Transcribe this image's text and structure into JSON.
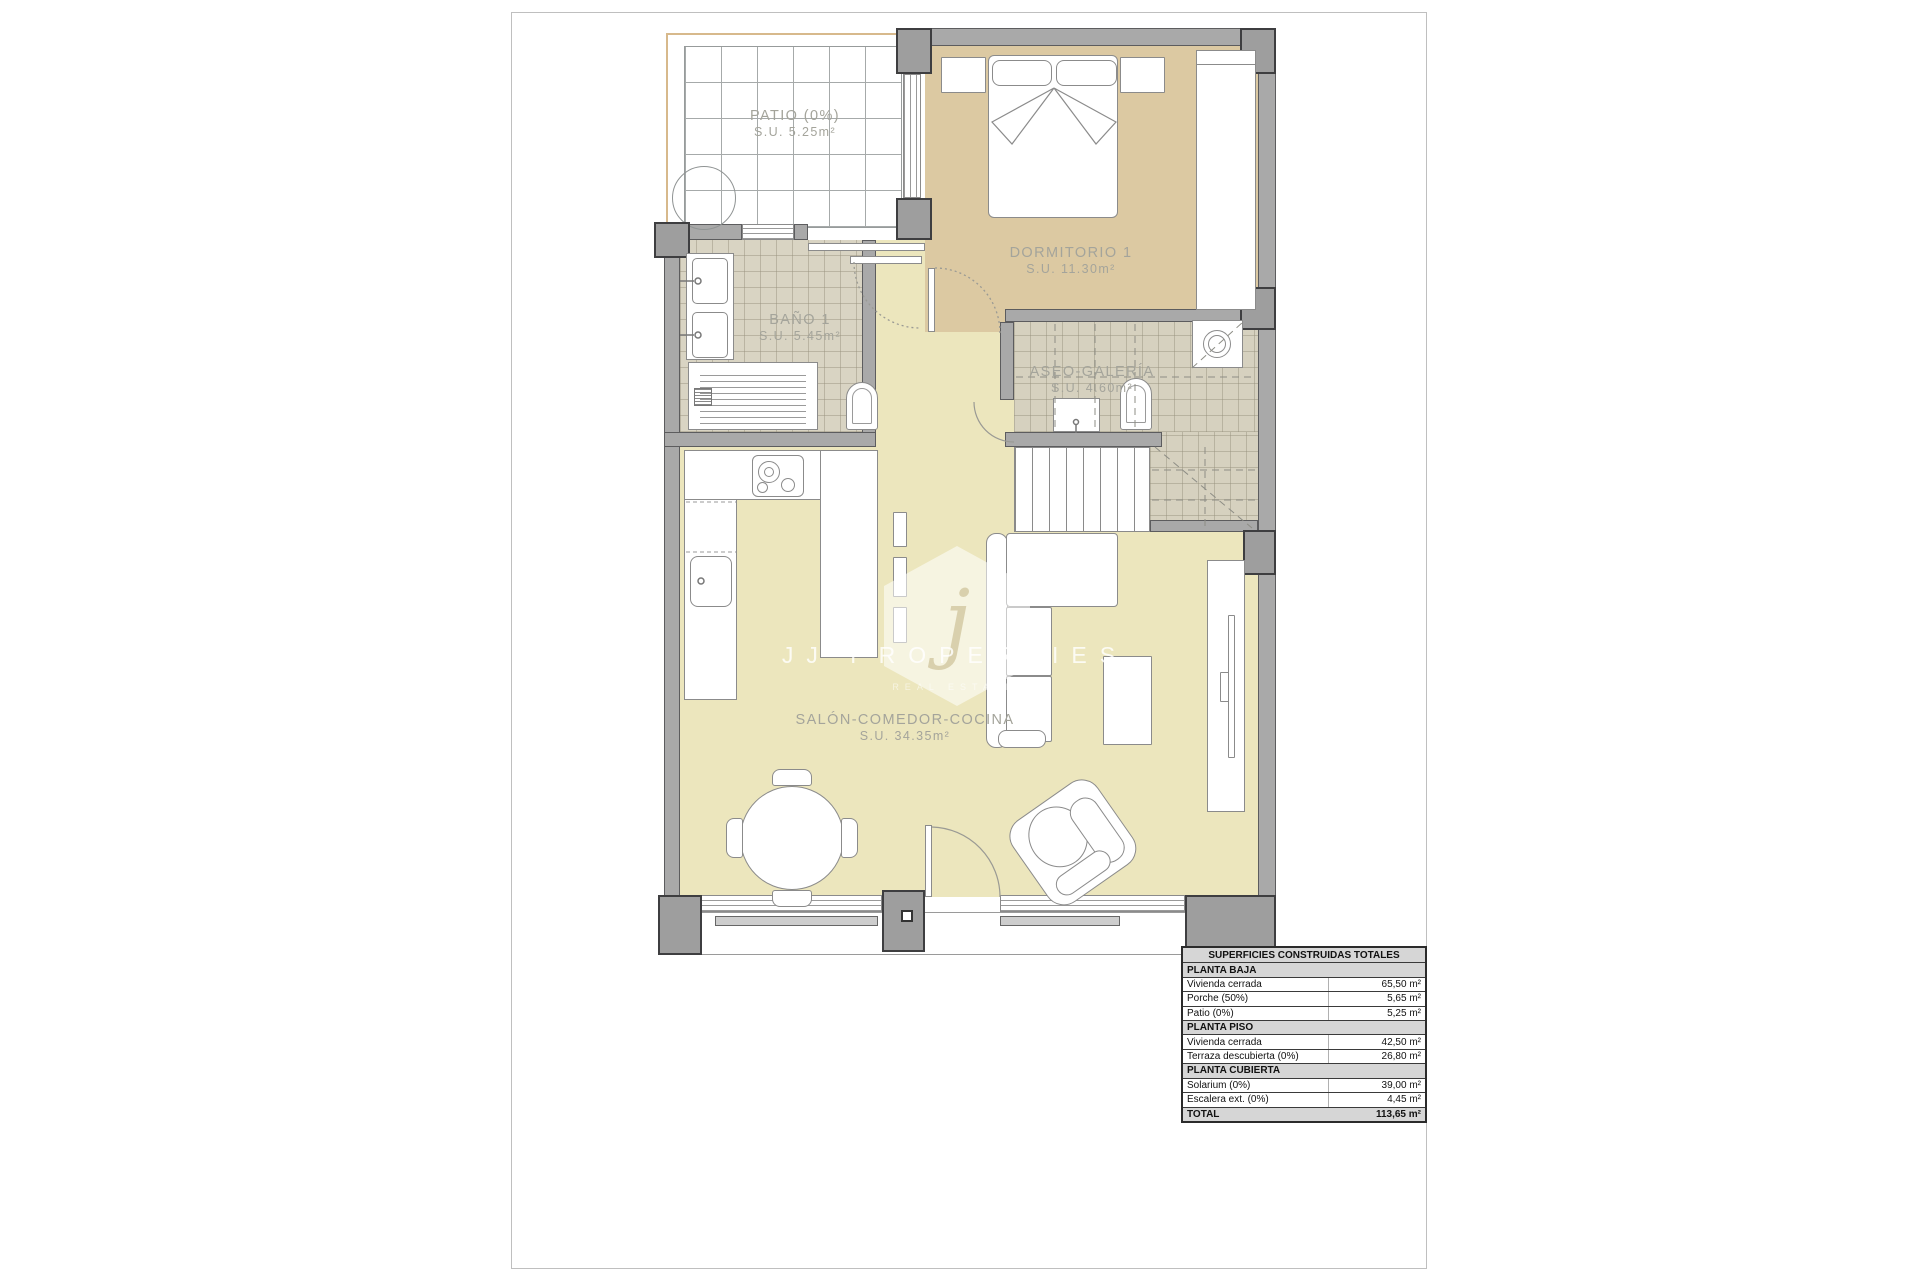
{
  "watermark": {
    "monogram": "j",
    "brand": "JJ PROPERTIES",
    "tagline": "REAL ESTATE"
  },
  "rooms": {
    "patio": {
      "name": "PATIO (0%)",
      "area": "S.U. 5.25m²"
    },
    "dormitorio": {
      "name": "DORMITORIO 1",
      "area": "S.U. 11.30m²"
    },
    "bano": {
      "name": "BAÑO 1",
      "area": "S.U. 5.45m²"
    },
    "aseo": {
      "name": "ASEO-GALERÍA",
      "area": "S.U. 4.60m²"
    },
    "salon": {
      "name": "SALÓN-COMEDOR-COCINA",
      "area": "S.U. 34.35m²"
    }
  },
  "surfaces_table": {
    "title": "SUPERFICIES CONSTRUIDAS TOTALES",
    "rows": [
      {
        "type": "section",
        "label": "PLANTA BAJA"
      },
      {
        "type": "data",
        "label": "Vivienda cerrada",
        "value": "65,50 m²"
      },
      {
        "type": "data",
        "label": "Porche (50%)",
        "value": "5,65 m²"
      },
      {
        "type": "data",
        "label": "Patio (0%)",
        "value": "5,25 m²"
      },
      {
        "type": "section",
        "label": "PLANTA PISO"
      },
      {
        "type": "data",
        "label": "Vivienda cerrada",
        "value": "42,50 m²"
      },
      {
        "type": "data",
        "label": "Terraza descubierta (0%)",
        "value": "26,80 m²"
      },
      {
        "type": "section",
        "label": "PLANTA CUBIERTA"
      },
      {
        "type": "data",
        "label": "Solarium (0%)",
        "value": "39,00 m²"
      },
      {
        "type": "data",
        "label": "Escalera ext. (0%)",
        "value": "4,45 m²"
      },
      {
        "type": "total",
        "label": "TOTAL",
        "value": "113,65 m²"
      }
    ]
  },
  "colors": {
    "wall": "#a9a9a9",
    "pillar": "#9e9e9e",
    "living_floor": "#ece6bd",
    "bedroom_floor": "#dcc9a2",
    "bath_floor": "#d9d4c3",
    "label_text": "#a4a49b",
    "table_shading": "#d6d6d6",
    "plot_line": "#d7b98c"
  }
}
